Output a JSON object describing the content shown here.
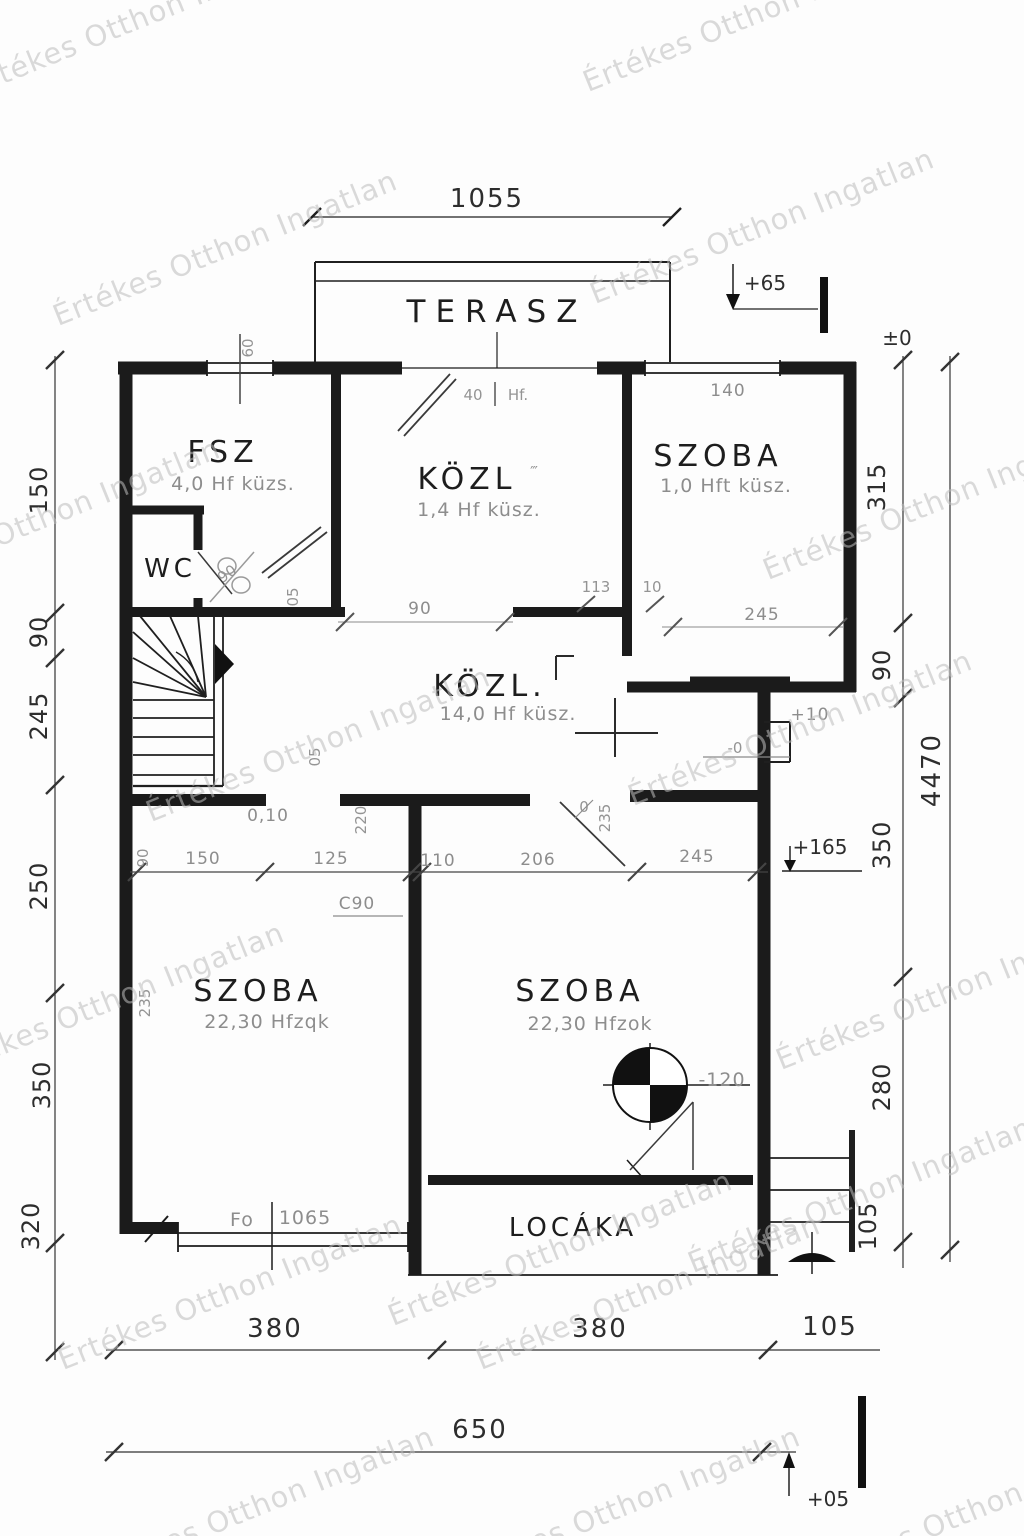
{
  "watermark": {
    "text": "Értékes Otthon Ingatlan"
  },
  "top": {
    "dim": "1055",
    "terrace": "TERASZ",
    "level": "+65",
    "zero": "±0"
  },
  "rooms": {
    "fsz": {
      "name": "FSZ",
      "note": "4,0 Hf küzs."
    },
    "wc": {
      "name": "WC",
      "door": "90"
    },
    "kozl": {
      "name": "KÖZL",
      "marks": "‴",
      "note": "1,4 Hf küsz."
    },
    "szoba_ne": {
      "name": "SZOBA",
      "note": "1,0 Hft küsz.",
      "window": "140"
    },
    "hall": {
      "name": "KÖZL.",
      "note": "14,0 Hf küsz."
    },
    "szoba_sw": {
      "name": "SZOBA",
      "note": "22,30 Hfzqk",
      "wall": "235",
      "win_label": "Fo",
      "win_dim": "1065"
    },
    "szoba_se": {
      "name": "SZOBA",
      "note": "22,30 Hfzok",
      "level": "-120"
    },
    "locaka": {
      "name": "LOCÁKA"
    }
  },
  "notes": {
    "door40": "40",
    "door40b": "Hf.",
    "win60": "60",
    "d05a": "05",
    "d05b": "05",
    "sill": "0,10",
    "d220": "220",
    "c90": "C90",
    "d235": "235",
    "zero": "0",
    "step": "+10",
    "lvl0": "-0",
    "d113": "113",
    "d10": "10",
    "open90": "90",
    "d245": "245"
  },
  "mid": {
    "v90": "90",
    "d150": "150",
    "d125": "125",
    "d110": "110",
    "d206": "206",
    "d245": "245",
    "level": "+165"
  },
  "left": [
    "150",
    "90",
    "245",
    "250",
    "350",
    "320"
  ],
  "right": [
    "315",
    "90",
    "350",
    "280",
    "105"
  ],
  "total_h": "4470",
  "bottom": {
    "d1": "380",
    "d2": "380",
    "d3": "105",
    "total": "650",
    "level": "+05"
  }
}
